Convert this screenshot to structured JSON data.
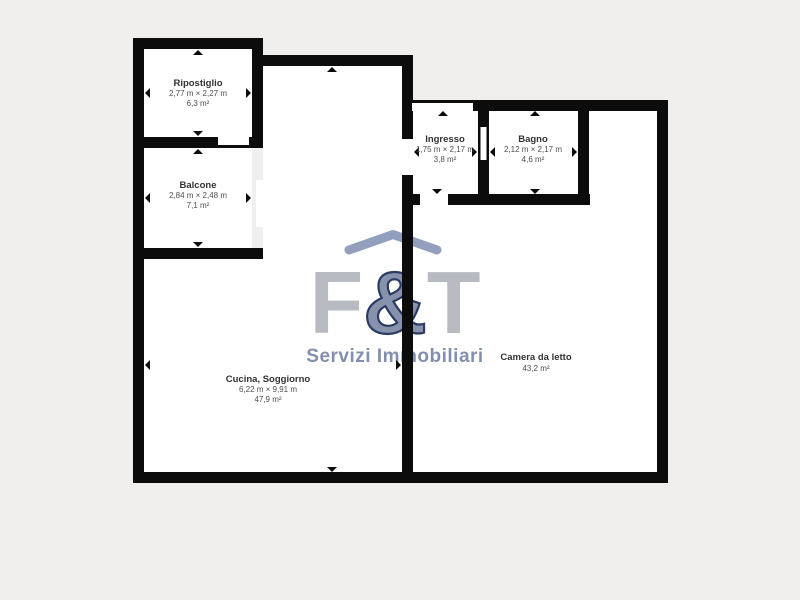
{
  "watermark": {
    "f": "F",
    "amp": "&",
    "t": "T",
    "tagline": "Servizi Immobiliari"
  },
  "colors": {
    "background": "#f0efed",
    "floor": "#ffffff",
    "wall": "#0c0c0c",
    "logo_gray": "#b7bac0",
    "logo_blue": "#8792ad",
    "logo_blue_edge": "#2b3b63",
    "logo_roof": "#93a0bd",
    "tagline_color": "#8290ae"
  },
  "rooms": [
    {
      "name": "Ripostiglio",
      "dimensions": "2,77 m × 2,27 m",
      "area": "6,3 m²"
    },
    {
      "name": "Balcone",
      "dimensions": "2,84 m × 2,48 m",
      "area": "7,1 m²"
    },
    {
      "name": "Ingresso",
      "dimensions": "1,75 m × 2,17 m",
      "area": "3,8 m²"
    },
    {
      "name": "Bagno",
      "dimensions": "2,12 m × 2,17 m",
      "area": "4,6 m²"
    },
    {
      "name": "Cucina, Soggiorno",
      "dimensions": "6,22 m × 9,91 m",
      "area": "47,9 m²"
    },
    {
      "name": "Camera da letto",
      "area": "43,2 m²"
    }
  ]
}
